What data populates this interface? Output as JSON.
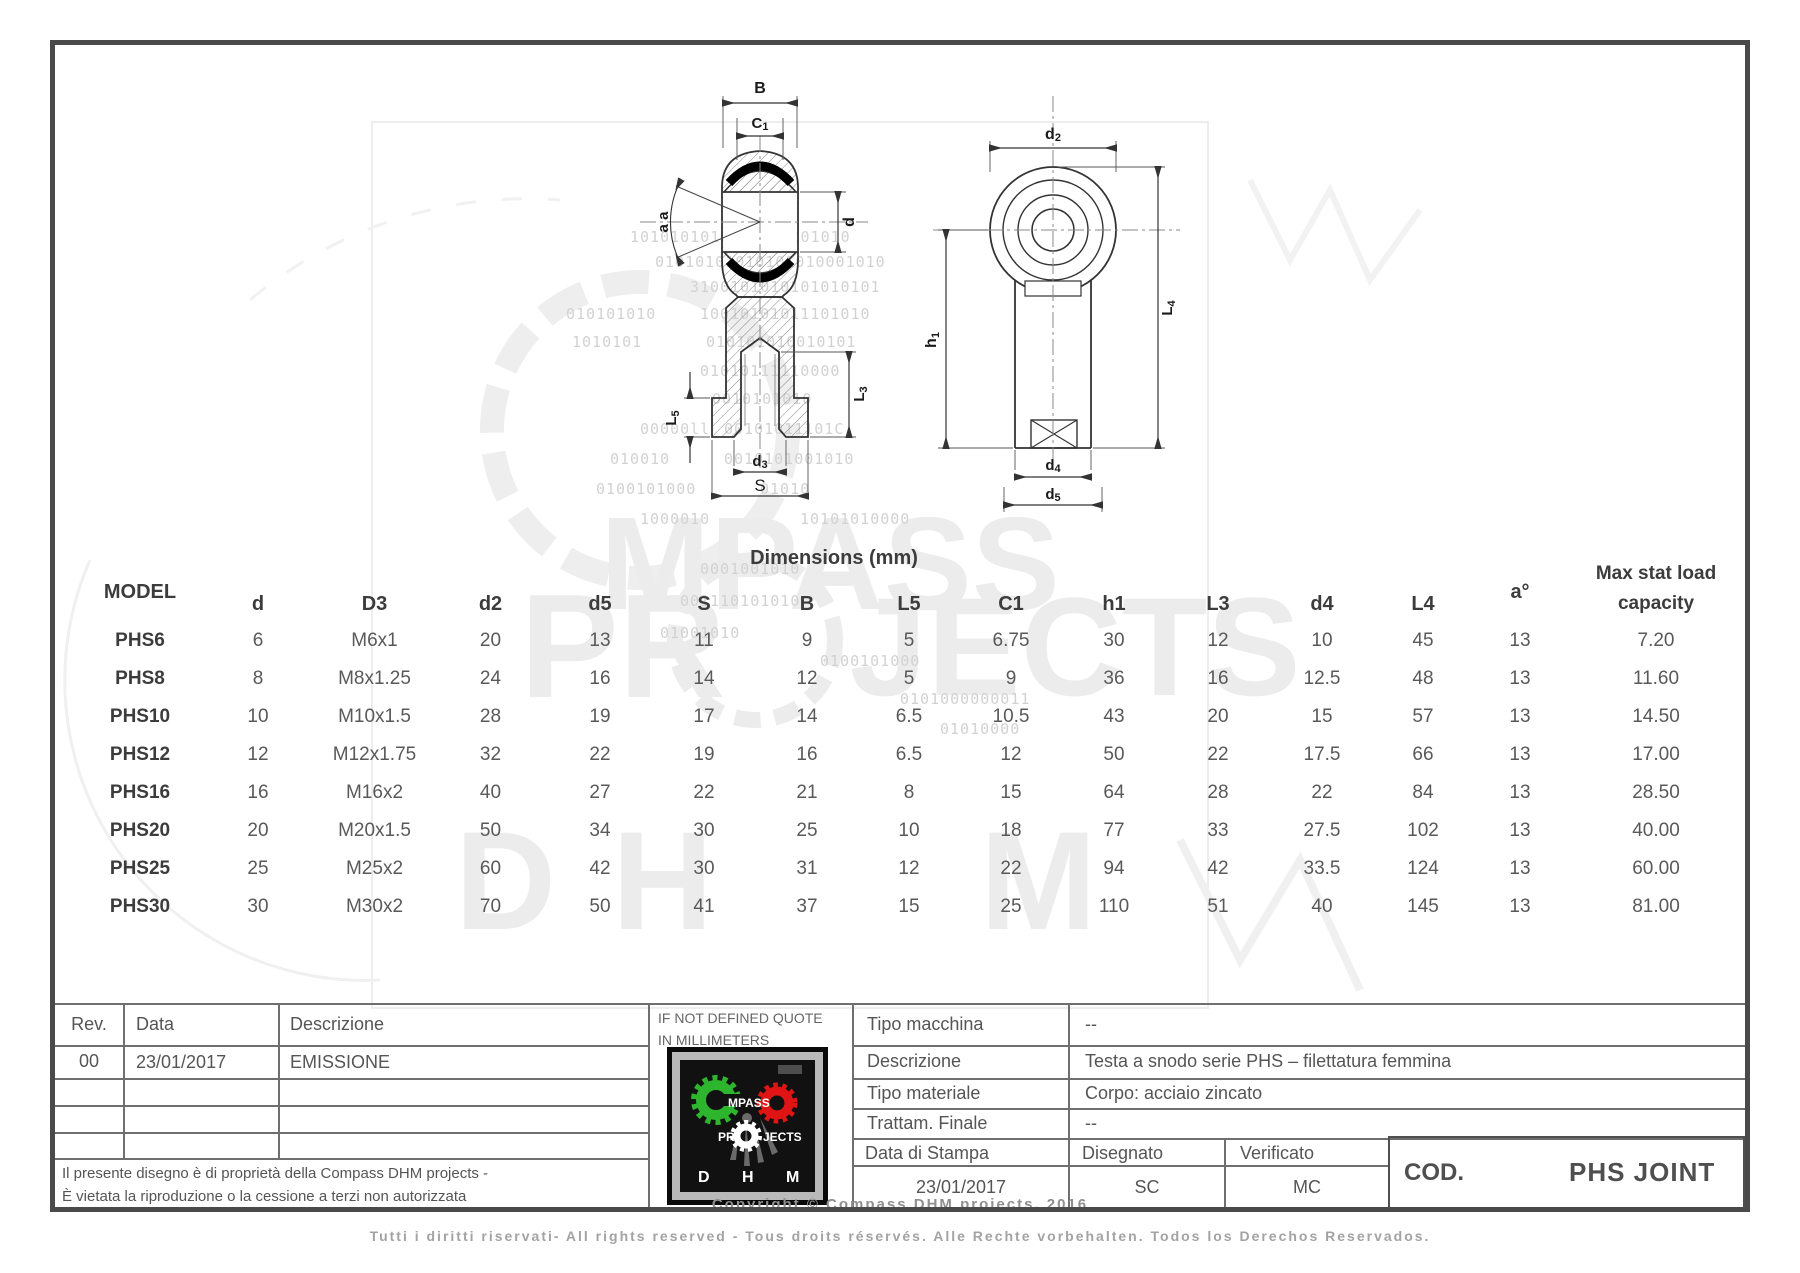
{
  "page": {
    "copyright": "Copyright © Compass DHM projects, 2016",
    "footer": "Tutti i diritti riservati- All rights reserved - Tous droits réservés. Alle Rechte vorbehalten. Todos los Derechos Reservados."
  },
  "drawing": {
    "labels": {
      "B": {
        "t": "B"
      },
      "C1": {
        "t": "C",
        "s": "1"
      },
      "a": {
        "t": "a a"
      },
      "d": {
        "t": "d"
      },
      "L3": {
        "t": "L",
        "s": "3"
      },
      "L5": {
        "t": "L",
        "s": "5"
      },
      "d3": {
        "t": "d",
        "s": "3"
      },
      "S": {
        "t": "S"
      },
      "d2": {
        "t": "d",
        "s": "2"
      },
      "h1": {
        "t": "h",
        "s": "1"
      },
      "L4": {
        "t": "L",
        "s": "4"
      },
      "d4": {
        "t": "d",
        "s": "4"
      },
      "d5": {
        "t": "d",
        "s": "5"
      }
    },
    "line_color": "#333333"
  },
  "table": {
    "title": "Dimensions (mm)",
    "model_header": "MODEL",
    "columns": [
      "d",
      "D3",
      "d2",
      "d5",
      "S",
      "B",
      "L5",
      "C1",
      "h1",
      "L3",
      "d4",
      "L4",
      "a°",
      "Max stat load capacity"
    ],
    "rows": [
      {
        "model": "PHS6",
        "values": [
          "6",
          "M6x1",
          "20",
          "13",
          "11",
          "9",
          "5",
          "6.75",
          "30",
          "12",
          "10",
          "45",
          "13",
          "7.20"
        ]
      },
      {
        "model": "PHS8",
        "values": [
          "8",
          "M8x1.25",
          "24",
          "16",
          "14",
          "12",
          "5",
          "9",
          "36",
          "16",
          "12.5",
          "48",
          "13",
          "11.60"
        ]
      },
      {
        "model": "PHS10",
        "values": [
          "10",
          "M10x1.5",
          "28",
          "19",
          "17",
          "14",
          "6.5",
          "10.5",
          "43",
          "20",
          "15",
          "57",
          "13",
          "14.50"
        ]
      },
      {
        "model": "PHS12",
        "values": [
          "12",
          "M12x1.75",
          "32",
          "22",
          "19",
          "16",
          "6.5",
          "12",
          "50",
          "22",
          "17.5",
          "66",
          "13",
          "17.00"
        ]
      },
      {
        "model": "PHS16",
        "values": [
          "16",
          "M16x2",
          "40",
          "27",
          "22",
          "21",
          "8",
          "15",
          "64",
          "28",
          "22",
          "84",
          "13",
          "28.50"
        ]
      },
      {
        "model": "PHS20",
        "values": [
          "20",
          "M20x1.5",
          "50",
          "34",
          "30",
          "25",
          "10",
          "18",
          "77",
          "33",
          "27.5",
          "102",
          "13",
          "40.00"
        ]
      },
      {
        "model": "PHS25",
        "values": [
          "25",
          "M25x2",
          "60",
          "42",
          "30",
          "31",
          "12",
          "22",
          "94",
          "42",
          "33.5",
          "124",
          "13",
          "60.00"
        ]
      },
      {
        "model": "PHS30",
        "values": [
          "30",
          "M30x2",
          "70",
          "50",
          "41",
          "37",
          "15",
          "25",
          "110",
          "51",
          "40",
          "145",
          "13",
          "81.00"
        ]
      }
    ]
  },
  "title_block": {
    "rev_header": "Rev.",
    "data_header": "Data",
    "descr_header": "Descrizione",
    "rev_value": "00",
    "rev_date": "23/01/2017",
    "rev_descr": "EMISSIONE",
    "note_line1": "Il presente disegno è di proprietà della Compass DHM projects -",
    "note_line2": "È vietata la riproduzione o la cessione a terzi non autorizzata",
    "quote_line1": "IF NOT DEFINED QUOTE",
    "quote_line2": "IN MILLIMETERS",
    "fields": [
      {
        "label": "Tipo macchina",
        "value": "--"
      },
      {
        "label": "Descrizione",
        "value": "Testa a snodo serie PHS – filettatura femmina"
      },
      {
        "label": "Tipo materiale",
        "value": "Corpo: acciaio zincato"
      },
      {
        "label": "Trattam. Finale",
        "value": "--"
      }
    ],
    "stampa_label": "Data di Stampa",
    "disegnato_label": "Disegnato",
    "verificato_label": "Verificato",
    "stampa_value": "23/01/2017",
    "disegnato_value": "SC",
    "verificato_value": "MC",
    "cod_label": "COD.",
    "cod_value": "PHS JOINT"
  },
  "logo": {
    "word1": "MPASS",
    "word2a": "PR",
    "word2b": "JECTS",
    "d": "D",
    "h": "H",
    "m": "M",
    "green": "#2db52d",
    "red": "#e01414",
    "white": "#ffffff"
  },
  "watermark": {
    "ghost": [
      "MPASS",
      "PR",
      "JECTS",
      "D",
      "H",
      "M"
    ],
    "binary_rows": [
      {
        "x": 630,
        "y": 228,
        "text": "1010101010101010101010"
      },
      {
        "x": 655,
        "y": 253,
        "text": "01010101010101010001010"
      },
      {
        "x": 690,
        "y": 278,
        "text": "3100101010101010101"
      },
      {
        "x": 566,
        "y": 305,
        "text": "010101010"
      },
      {
        "x": 700,
        "y": 305,
        "text": "10010101011101010"
      },
      {
        "x": 572,
        "y": 333,
        "text": "1010101"
      },
      {
        "x": 706,
        "y": 333,
        "text": "010101010010101"
      },
      {
        "x": 700,
        "y": 362,
        "text": "01010111110000"
      },
      {
        "x": 712,
        "y": 390,
        "text": "0010101010"
      },
      {
        "x": 640,
        "y": 420,
        "text": "00000ll"
      },
      {
        "x": 724,
        "y": 420,
        "text": "00101011101C"
      },
      {
        "x": 610,
        "y": 450,
        "text": "010010"
      },
      {
        "x": 724,
        "y": 450,
        "text": "0010101001010"
      },
      {
        "x": 596,
        "y": 480,
        "text": "0100101000"
      },
      {
        "x": 760,
        "y": 480,
        "text": "01010"
      },
      {
        "x": 640,
        "y": 510,
        "text": "1000010"
      },
      {
        "x": 800,
        "y": 510,
        "text": "10101010000"
      },
      {
        "x": 700,
        "y": 560,
        "text": "0001001010"
      },
      {
        "x": 680,
        "y": 592,
        "text": "001110101010"
      },
      {
        "x": 660,
        "y": 624,
        "text": "01001010"
      },
      {
        "x": 820,
        "y": 652,
        "text": "0100101000"
      },
      {
        "x": 900,
        "y": 690,
        "text": "0101000000011"
      },
      {
        "x": 940,
        "y": 720,
        "text": "01010000"
      }
    ]
  }
}
